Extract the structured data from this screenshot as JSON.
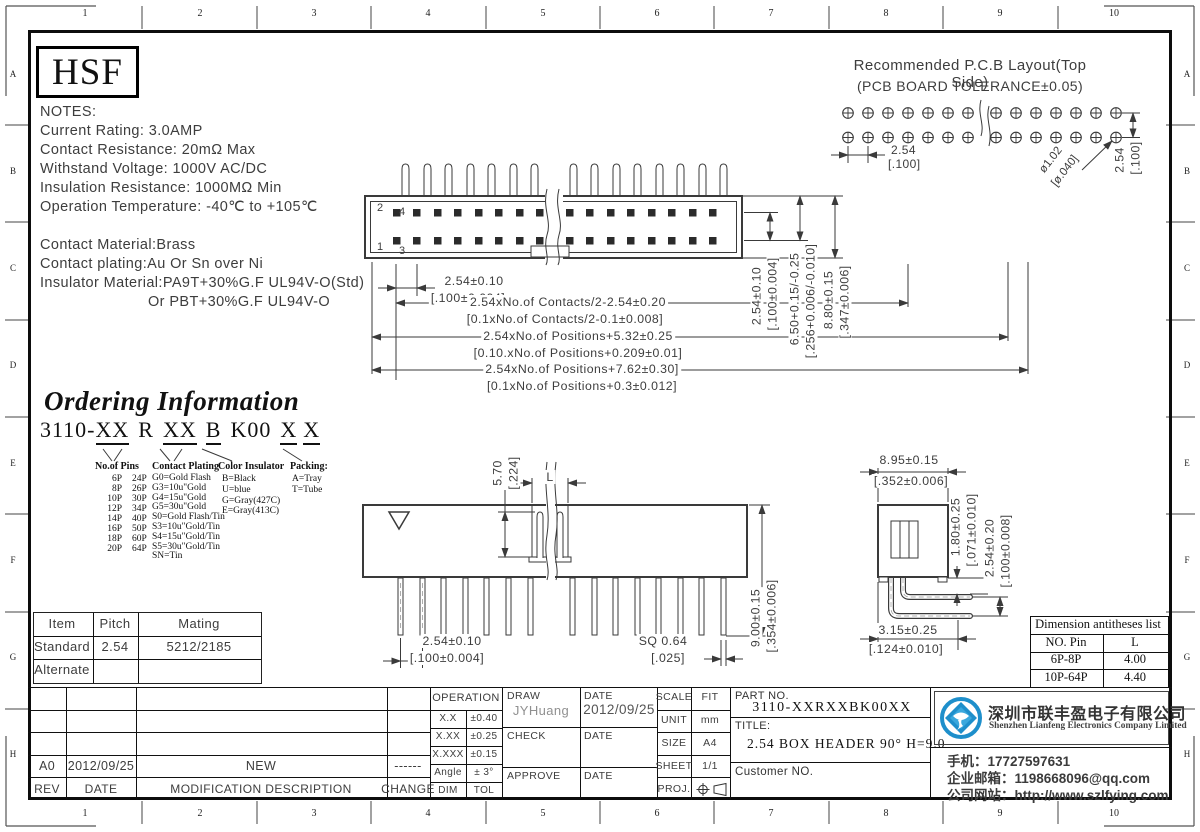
{
  "ruler": {
    "top": [
      "1",
      "2",
      "3",
      "4",
      "5",
      "6",
      "7",
      "8",
      "9",
      "10"
    ],
    "bottom": [
      "1",
      "2",
      "3",
      "4",
      "5",
      "6",
      "7",
      "8",
      "9",
      "10"
    ],
    "left": [
      "A",
      "B",
      "C",
      "D",
      "E",
      "F",
      "G",
      "H"
    ],
    "right": [
      "A",
      "B",
      "C",
      "D",
      "E",
      "F",
      "G",
      "H"
    ]
  },
  "logo_text": "HSF",
  "notes": {
    "title": "NOTES:",
    "lines": [
      "Current Rating: 3.0AMP",
      "Contact Resistance: 20mΩ Max",
      "Withstand Voltage: 1000V AC/DC",
      "Insulation Resistance: 1000MΩ Min",
      "Operation Temperature: -40℃ to +105℃"
    ],
    "materials": [
      "Contact Material:Brass",
      "Contact plating:Au Or Sn over Ni",
      "Insulator Material:PA9T+30%G.F UL94V-O(Std)",
      "Or PBT+30%G.F UL94V-O"
    ]
  },
  "pcb": {
    "title": "Recommended P.C.B Layout(Top Side)",
    "subtitle": "(PCB BOARD TOLERANCE±0.05)",
    "pitch": "2.54",
    "pitch_in": "[.100]",
    "hole": "ø1.02",
    "hole_in": "[ø.040]",
    "row": "2.54",
    "row_in": "[.100]"
  },
  "top_view": {
    "pin1": "1",
    "pin2": "2",
    "pin3": "3",
    "pin4": "4",
    "pitch": "2.54±0.10",
    "pitch_in": "[.100±0.004]",
    "contacts": "2.54xNo.of Contacts/2-2.54±0.20",
    "contacts_in": "[0.1xNo.of Contacts/2-0.1±0.008]",
    "positions1": "2.54xNo.of Positions+5.32±0.25",
    "positions1_in": "[0.10.xNo.of Positions+0.209±0.01]",
    "positions2": "2.54xNo.of Positions+7.62±0.30]",
    "positions2_in": "[0.1xNo.of Positions+0.3±0.012]",
    "v1": "2.54±0.10",
    "v1_in": "[.100±0.004]",
    "v2": "6.50+0.15/-0.25",
    "v2_in": "[.256+0.006/-0.010]",
    "v3": "8.80±0.15",
    "v3_in": "[.347±0.006]"
  },
  "ordering": {
    "title": "Ordering Information",
    "code": {
      "prefix": "3110-",
      "pins": "XX",
      "r": "R",
      "plating": "XX",
      "color": "B",
      "pack": "K00",
      "x1": "X",
      "x2": "X"
    },
    "pins_header": "No.of Pins",
    "pins_rows": [
      [
        "6P",
        "24P"
      ],
      [
        "8P",
        "26P"
      ],
      [
        "10P",
        "30P"
      ],
      [
        "12P",
        "34P"
      ],
      [
        "14P",
        "40P"
      ],
      [
        "16P",
        "50P"
      ],
      [
        "18P",
        "60P"
      ],
      [
        "20P",
        "64P"
      ]
    ],
    "plating_header": "Contact Plating",
    "plating_items": [
      "G0=Gold Flash",
      "G3=10u\"Gold",
      "G4=15u\"Gold",
      "G5=30u\"Gold",
      "S0=Gold Flash/Tin",
      "S3=10u\"Gold/Tin",
      "S4=15u\"Gold/Tin",
      "S5=30u\"Gold/Tin",
      "SN=Tin"
    ],
    "color_header": "Color Insulator",
    "color_items": [
      "B=Black",
      "U=blue",
      "G=Gray(427C)",
      "E=Gray(413C)"
    ],
    "packing_header": "Packing:",
    "packing_items": [
      "A=Tray",
      "T=Tube"
    ]
  },
  "front_view": {
    "key": "5.70",
    "key_in": "[.224]",
    "l": "L",
    "pitch": "2.54±0.10",
    "pitch_in": "[.100±0.004]",
    "sq": "SQ 0.64",
    "sq_in": "[.025]",
    "height": "9.00±0.15",
    "height_in": "[.354±0.006]"
  },
  "side_view": {
    "w": "8.95±0.15",
    "w_in": "[.352±0.006]",
    "p1": "1.80±0.25",
    "p1_in": "[.071±0.010]",
    "p2": "2.54±0.20",
    "p2_in": "[.100±0.008]",
    "tail": "3.15±0.25",
    "tail_in": "[.124±0.010]"
  },
  "mating_table": {
    "h": [
      "Item",
      "Pitch",
      "Mating"
    ],
    "r1": [
      "Standard",
      "2.54",
      "5212/2185"
    ],
    "r2": [
      "Alternate"
    ]
  },
  "dim_table": {
    "title": "Dimension antitheses list",
    "h": [
      "NO. Pin",
      "L"
    ],
    "rows": [
      [
        "6P-8P",
        "4.00"
      ],
      [
        "10P-64P",
        "4.40"
      ]
    ]
  },
  "revision": {
    "entry": [
      "A0",
      "2012/09/25",
      "NEW",
      "------"
    ],
    "headers": [
      "REV",
      "DATE",
      "MODIFICATION DESCRIPTION",
      "CHANGE"
    ]
  },
  "titleblock": {
    "operation": {
      "title": "OPERATION",
      "rows": [
        [
          "X.X",
          "±0.40"
        ],
        [
          "X.XX",
          "±0.25"
        ],
        [
          "X.XXX",
          "±0.15"
        ],
        [
          "Angle",
          "± 3°"
        ],
        [
          "DIM",
          "TOL"
        ]
      ]
    },
    "sign": {
      "draw": "DRAW",
      "date": "DATE",
      "draw_name": "JYHuang",
      "draw_date": "2012/09/25",
      "check": "CHECK",
      "approve": "APPROVE"
    },
    "meta": {
      "scale": "SCALE",
      "scale_v": "FIT",
      "unit": "UNIT",
      "unit_v": "mm",
      "size": "SIZE",
      "size_v": "A4",
      "sheet": "SHEET",
      "sheet_v": "1/1",
      "proj": "PROJ."
    },
    "part": {
      "label": "PART NO.",
      "number": "3110-XXRXXBK00XX",
      "title_label": "TITLE:",
      "title": "2.54 BOX HEADER 90° H=9.0",
      "customer": "Customer NO."
    }
  },
  "company": {
    "cn": "深圳市联丰盈电子有限公司",
    "en": "Shenzhen Lianfeng Electronics Company Limited",
    "phone": "手机：17727597631",
    "email": "企业邮箱：1198668096@qq.com",
    "web": "公司网站：http://www.szlfying.com"
  },
  "colors": {
    "accent_blue": "#1e8fcb",
    "line": "#3a3a3a"
  }
}
